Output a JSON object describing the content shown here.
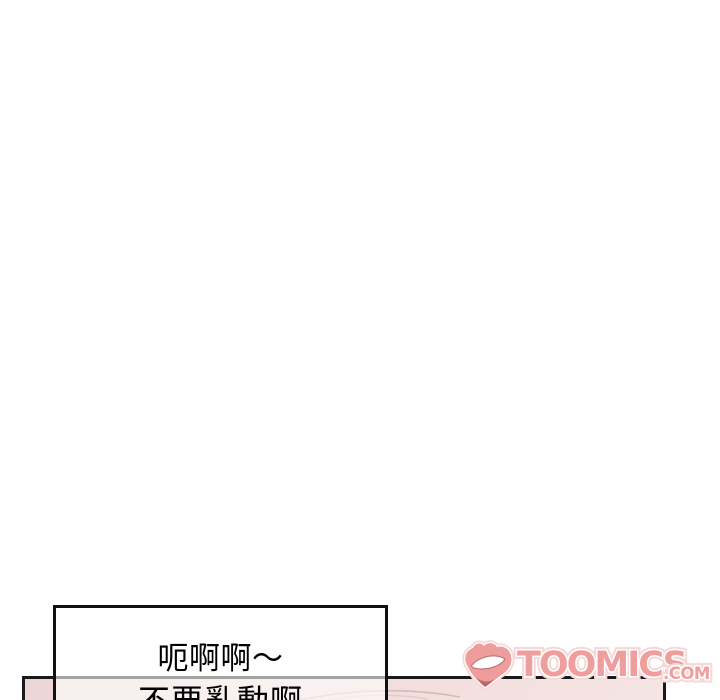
{
  "comic": {
    "speech_box": {
      "line1": "呃啊啊～",
      "line2": "不要亂動啊"
    }
  },
  "watermark": {
    "brand": "TOOMICS",
    "tld": ".COM",
    "mark_icon": "toomics-d-grin-mark"
  },
  "colors": {
    "page_background": "#ffffff",
    "panel_border": "#1a1a1a",
    "panel_fill_top": "#ecd6d5",
    "panel_fill_bottom": "#f5e5e3",
    "speech_box_border": "#111111",
    "watermark_pink": "#ef9e9e",
    "artwork_line_pink": "#d8b9b9"
  }
}
